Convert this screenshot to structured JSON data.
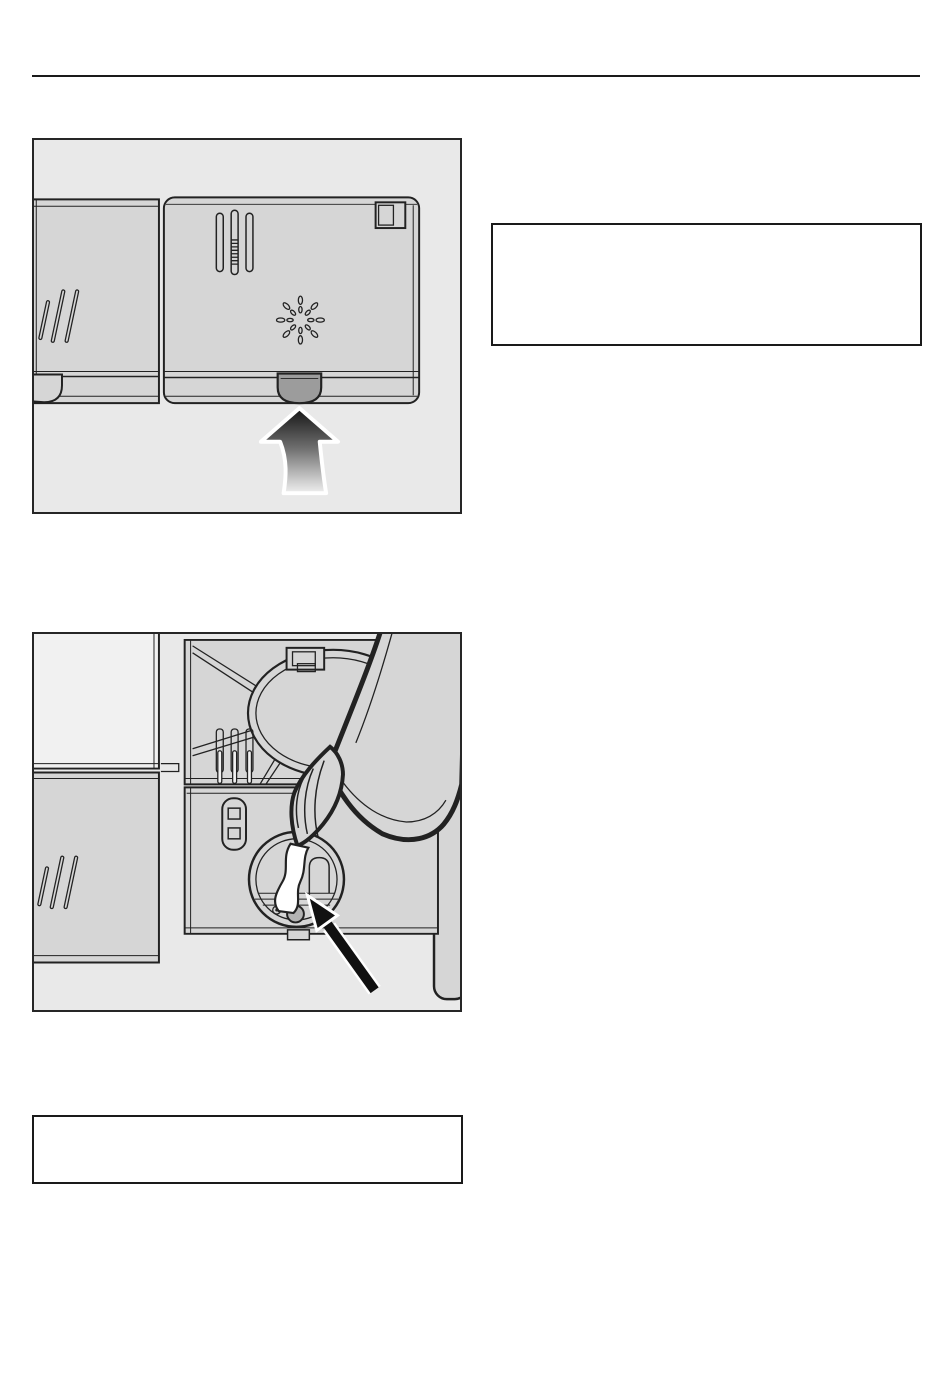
{
  "page": {
    "width": 950,
    "height": 1374
  },
  "colors": {
    "page_bg": "#ffffff",
    "rule": "#1a1a1a",
    "figure_bg": "#e9e9e9",
    "figure_border": "#262626",
    "drawing_fill": "#d6d6d6",
    "drawing_fill_light": "#f1f1f1",
    "line": "#222222",
    "tab_fill": "#9c9c9c",
    "button_fill": "#b3b3b3",
    "arrow_black": "#111111",
    "note_border": "#1a1a1a",
    "arrow_gradient_top": "#161616",
    "arrow_gradient_bottom": "#f7f7f7"
  },
  "figures": {
    "fig1": {
      "icon": "detergent-dispenser-closed-lid-release-arrow-illustration"
    },
    "fig2": {
      "icon": "rinse-aid-bottle-filling-dispenser-illustration"
    }
  },
  "notes": {
    "top": {
      "text": ""
    },
    "bottom": {
      "text": ""
    }
  }
}
